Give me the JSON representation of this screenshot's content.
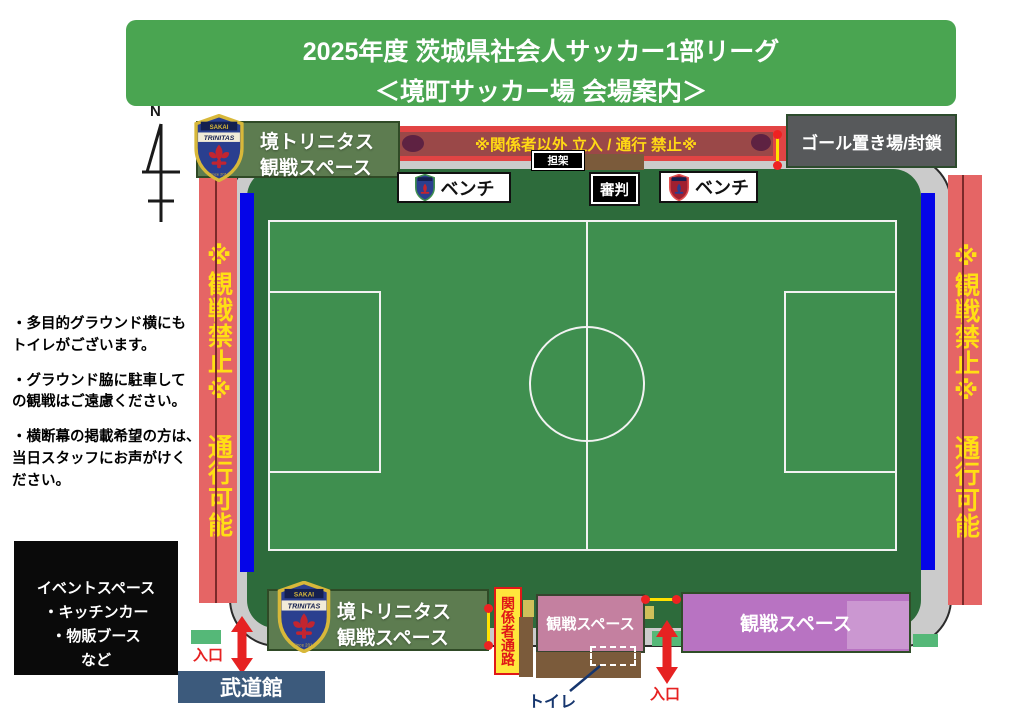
{
  "header": {
    "line1": "2025年度 茨城県社会人サッカー1部リーグ",
    "line2": "＜境町サッカー場 会場案内＞"
  },
  "compass": {
    "label": "N"
  },
  "banner": {
    "text": "※関係者以外 立入 / 通行 禁止※"
  },
  "stretcher": {
    "label": "担架"
  },
  "goal_storage": {
    "label": "ゴール置き場/封鎖"
  },
  "benches": {
    "home": "ベンチ",
    "away": "ベンチ",
    "referee": "審判"
  },
  "side_strips": {
    "left": "※観戦禁止※ 通行可能",
    "right": "※観戦禁止※ 通行可能"
  },
  "stands": {
    "top_home": {
      "line1": "境トリニタス",
      "line2": "観戦スペース"
    },
    "bottom_home": {
      "line1": "境トリニタス",
      "line2": "観戦スペース"
    },
    "pink_small": {
      "label": "観戦スペース"
    },
    "pink_large": {
      "label": "観戦スペース"
    }
  },
  "notes": {
    "n1a": "・多目的グラウンド横にも",
    "n1b": "トイレがございます。",
    "n2a": "・グラウンド脇に駐車して",
    "n2b": "の観戦はご遠慮ください。",
    "n3a": "・横断幕の掲載希望の方は、",
    "n3b": "当日スタッフにお声がけく",
    "n3c": "ださい。"
  },
  "event_space": {
    "line1": "イベントスペース",
    "line2": "・キッチンカー",
    "line3": "・物販ブース",
    "line4": "など"
  },
  "passage": {
    "label": "関係者通路"
  },
  "toilet": {
    "label": "トイレ"
  },
  "entrances": {
    "west": "入口",
    "south": "入口"
  },
  "budokan": {
    "label": "武道館"
  },
  "logo": {
    "club_top": "SAKAI",
    "club_name": "TRINITAS",
    "club_since": "Since 2014"
  },
  "colors": {
    "header_green": "#4aa551",
    "field_green_dark": "#2d6b3b",
    "field_green_light": "#3f8f4f",
    "surround_gray": "#cbcbcb",
    "strip_red": "#e56565",
    "strip_text_yellow": "#ffdf14",
    "banner_red": "#e24444",
    "banner_band": "#9a4848",
    "sideline_blue": "#0505e8",
    "stand_green": "#5d7c50",
    "pink_small": "#c480a0",
    "pink_large": "#b873c2",
    "passage_yellow": "#ffe63c",
    "brown": "#7b5b3b",
    "budokan_blue": "#3c5a7c",
    "arrow_red": "#e62222",
    "small_green": "#55b878"
  }
}
